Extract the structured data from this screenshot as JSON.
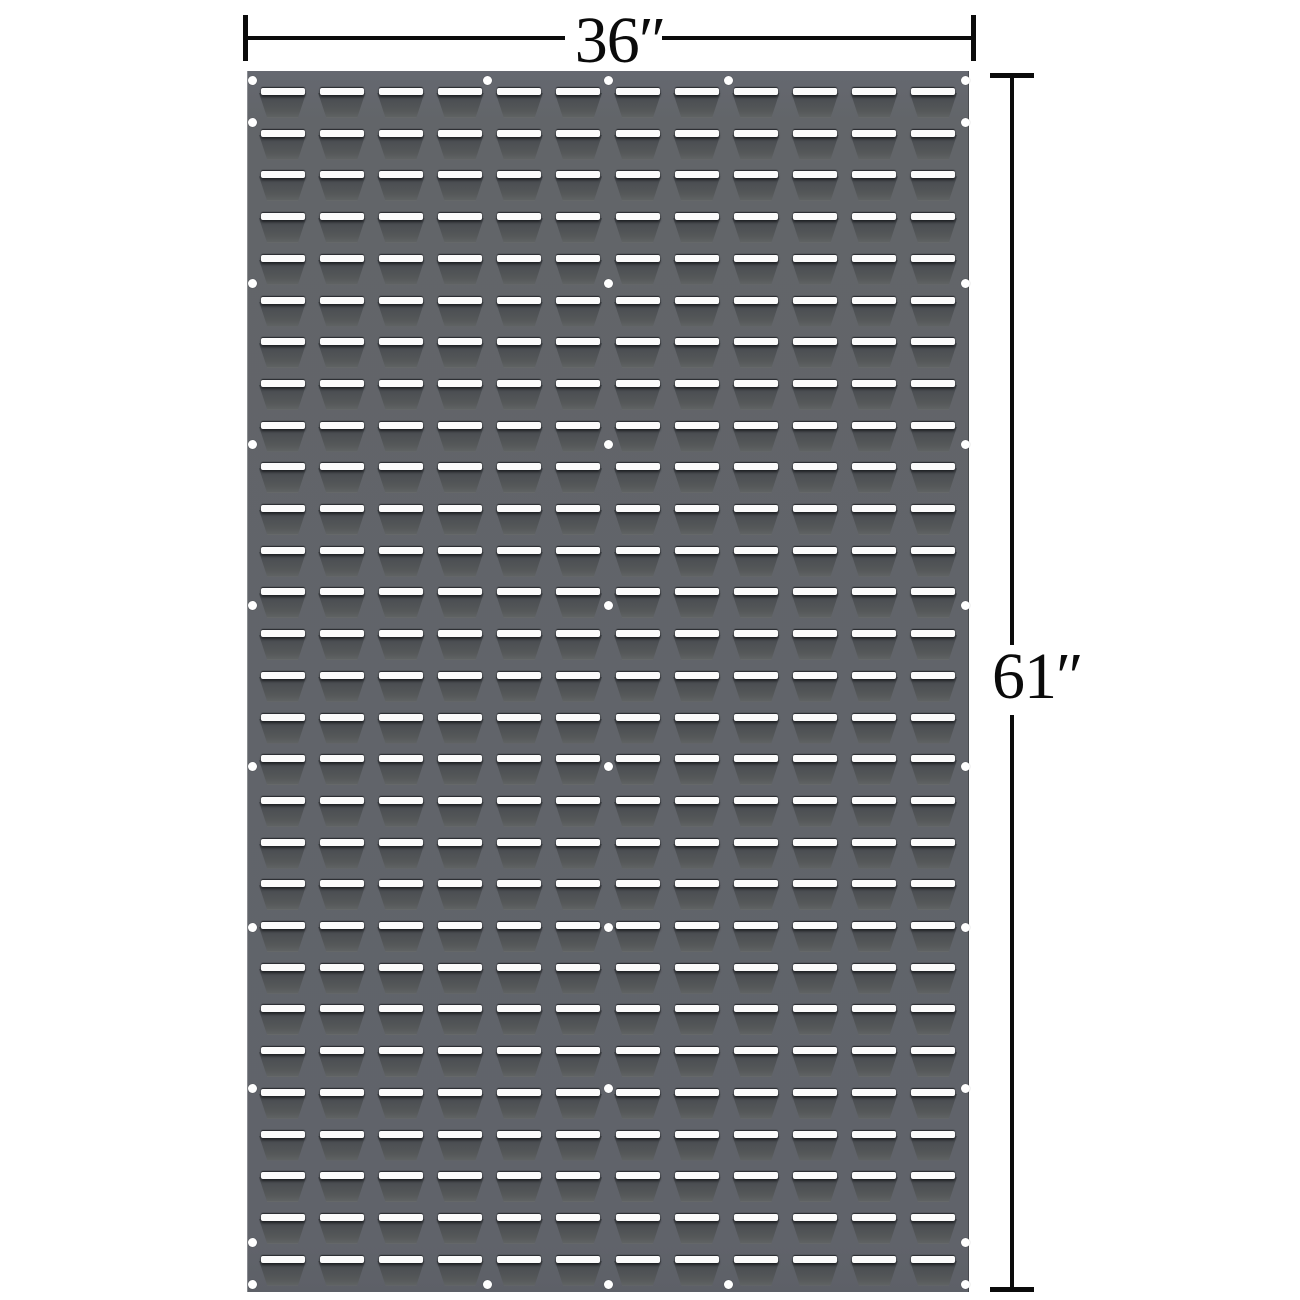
{
  "figure": {
    "type": "product-dimension-diagram",
    "subject": "louvered panel"
  },
  "dimensions": {
    "width_label": "36″",
    "height_label": "61″"
  },
  "panel": {
    "color": "#626569",
    "slot_color": "#fbfbfb",
    "pocket_dark_color": "#46494d",
    "hole_color": "#ffffff",
    "grid": {
      "rows": 29,
      "cols": 12,
      "pad_left": 6,
      "pad_right": 6,
      "top_offset": 17,
      "row_pitch": 41.7,
      "louver_width": 48
    },
    "holes": [
      [
        5,
        9
      ],
      [
        240,
        9
      ],
      [
        361,
        9
      ],
      [
        481,
        9
      ],
      [
        718,
        9
      ],
      [
        5,
        51
      ],
      [
        718,
        51
      ],
      [
        5,
        212
      ],
      [
        361,
        212
      ],
      [
        718,
        212
      ],
      [
        5,
        373
      ],
      [
        361,
        373
      ],
      [
        718,
        373
      ],
      [
        5,
        534
      ],
      [
        361,
        534
      ],
      [
        718,
        534
      ],
      [
        5,
        695
      ],
      [
        361,
        695
      ],
      [
        718,
        695
      ],
      [
        5,
        856
      ],
      [
        361,
        856
      ],
      [
        718,
        856
      ],
      [
        5,
        1017
      ],
      [
        361,
        1017
      ],
      [
        718,
        1017
      ],
      [
        5,
        1171
      ],
      [
        718,
        1171
      ],
      [
        5,
        1213
      ],
      [
        240,
        1213
      ],
      [
        361,
        1213
      ],
      [
        481,
        1213
      ],
      [
        718,
        1213
      ]
    ]
  }
}
